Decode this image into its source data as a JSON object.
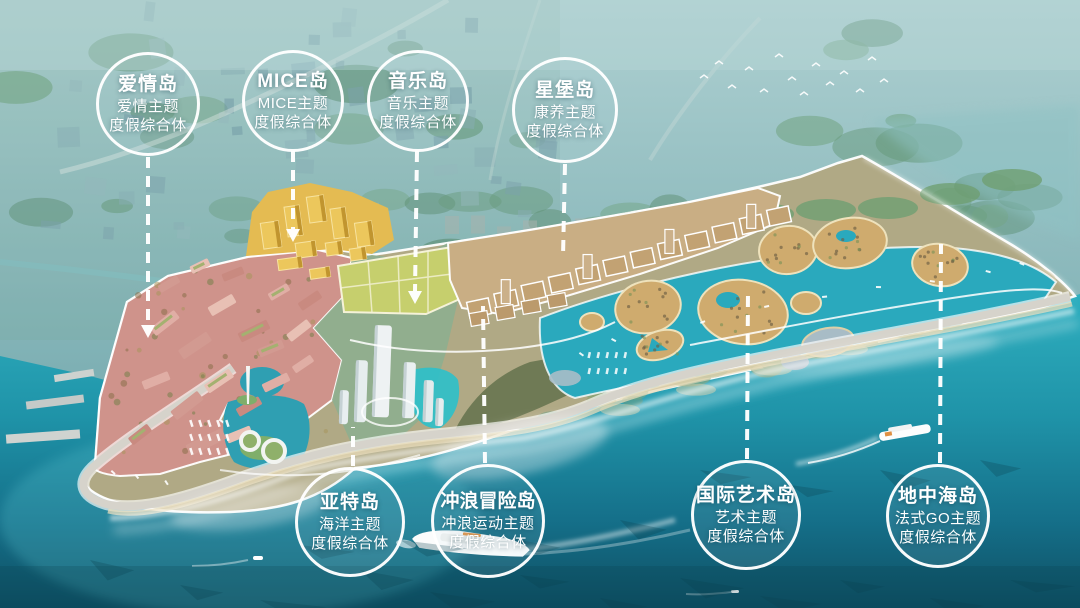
{
  "callouts": [
    {
      "title": "爱情岛",
      "line1": "爱情主题",
      "line2": "度假综合体"
    },
    {
      "title": "MICE岛",
      "line1": "MICE主题",
      "line2": "度假综合体"
    },
    {
      "title": "音乐岛",
      "line1": "音乐主题",
      "line2": "度假综合体"
    },
    {
      "title": "星堡岛",
      "line1": "康养主题",
      "line2": "度假综合体"
    },
    {
      "title": "亚特岛",
      "line1": "海洋主题",
      "line2": "度假综合体"
    },
    {
      "title": "冲浪冒险岛",
      "line1": "冲浪运动主题",
      "line2": "度假综合体"
    },
    {
      "title": "国际艺术岛",
      "line1": "艺术主题",
      "line2": "度假综合体"
    },
    {
      "title": "地中海岛",
      "line1": "法式GO主题",
      "line2": "度假综合体"
    }
  ],
  "colors": {
    "haze_top": "#aed0d1",
    "haze_mid": "#7eb0b4",
    "forest": "#5f9277",
    "city_block": "#84a9b0",
    "ocean_bright": "#2fb0c0",
    "ocean_mid": "#177c92",
    "ocean_deep": "#0e4f63",
    "lagoon": "#2aa9bd",
    "surf_foam": "#ffffff",
    "zone_pink": "#cf938b",
    "zone_gold": "#e4bb52",
    "zone_lime": "#c6cf6d",
    "zone_tan": "#c9ae84",
    "island_sand": "#cfab6e",
    "road": "#d6d3cb",
    "outline_white": "#ffffff"
  }
}
